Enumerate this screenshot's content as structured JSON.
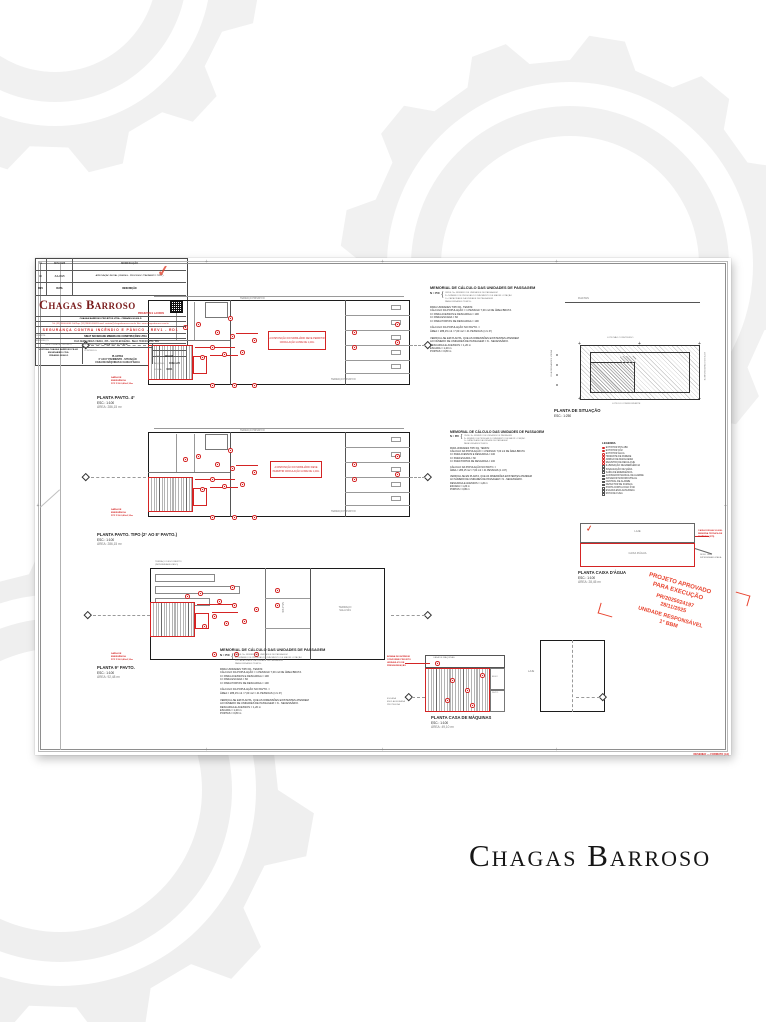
{
  "brand": {
    "wordmark": "Chagas Barroso"
  },
  "frame": {
    "note": "DESENHO — FORMATO (A1)"
  },
  "memorial": {
    "title": "MEMORIAL DE CÁLCULO DAS UNIDADES DE PASSAGEM",
    "formula": "N = P/C",
    "where": "ONDE: N= NÚMERO DE UNIDADES DE PASSAGEM\nP= NÚMERO DE PESSOAS DO PAVIMENTO DE MAIOR LOTAÇÃO\nC= CAPACIDADE DA UNIDADE DE PASSAGEM\nPARA UNIDADES TEMOS:",
    "body": "PARA UNIDADES TIPO D1, TEMOS:\nCÁLCULO DA POPULAÇÃO = 1 PESSOA/ 7,00 m2 DE ÁREA BRUTA\nC= PARA ACESSOS E DESCARGA = 100\nC= PARA ESCADA = 60\nC= PARA PORTAS DE DESCARGA = 100\n\nCÁLCULO DA POPULAÇÃO NO PAVTO. =\nÁREA = 286,15 m2 / 7,00 m2 = 41 PESSOAS (1 U.P.)\n\nVERIFICA-SE EM PLANTA, QUE AS DIMENSÕES EXISTENTES ATENDEM\nAO NÚMERO DE UNIDADES DE PASSAGEM = N - NECESSÁRIO.\nDESCARGA E ACESSOS = 1,20 m\nESCADA = 1,20 m\nPORTAS = 0,80 m"
  },
  "plans": {
    "shared": {
      "scale": "ESC.: 1:100",
      "terrace": "TERRAÇO PRIVATIVO",
      "mobiliario": "A DISPOSIÇÃO DO MOBILIÁRIO\nDEVE PERMITIR CIRCULAÇÃO\nLIVRE DE 1,20m",
      "exit": "SAÍDA DE\nEMERGÊNCIA\nPCF P-90 0,80x2,10m"
    },
    "p4": {
      "title": "PLANTA PAVTO. 4°",
      "area": "ÁREA: 286,15 m²"
    },
    "tipo": {
      "title": "PLANTA PAVTO. TIPO (2° AO 8° PAVTO.)",
      "area": "ÁREA: 286,15 m²"
    },
    "p9": {
      "title": "PLANTA 9° PAVTO.",
      "area": "ÁREA: 92,48 m²",
      "terrace_note": "TERRAÇO DESCOBERTO\n(IMPERMEABILIZADO)",
      "room_mid": "SALA 901",
      "room_right": "TERRAÇO\nSALA 901"
    },
    "caixa": {
      "title": "PLANTA CAIXA D'ÁGUA",
      "scale": "ESC.: 1:100",
      "area": "ÁREA: 28,45 m²",
      "laje": "LAJE",
      "tank": "CAIXA D'ÁGUA",
      "ann_red": "CAIXA D'ÁGUA 10.000L\nRESERVA TÉCNICA DE\nINCÊNDIO (RTI)",
      "ann_gray": "NÍVEL LAJE\nIMPERMEABILIZADA"
    },
    "maq": {
      "title": "PLANTA CASA DE MÁQUINAS",
      "scale": "ESC.: 1:100",
      "area": "ÁREA: 49,10 m²",
      "room": "CASA DE MÁQUINAS",
      "laje": "LAJE",
      "elev": "ELEV.",
      "duto": "DUTO",
      "ann_red": "BOMBA DE INCÊNDIO\nCONFORME PROJETO\nHIDRÁULICO DE\nPRESSURIZAÇÃO",
      "ann_gray": "ESCADA\nENCLAUSURADA\nPROTEGIDA"
    },
    "situacao": {
      "title": "PLANTA DE SITUAÇÃO",
      "scale": "ESC.: 1:250",
      "street_top": "RUA PAIS",
      "street_left": "RUA FERNANDES VIEIRA",
      "lot_top": "LOTE NÃO CONSTRUÍDO",
      "lot_bottom": "LOTE DO CONFRONTANTE",
      "lot_right": "LOTE DO CONFRONTANTE"
    }
  },
  "legend": {
    "title": "LEGENDA",
    "items": [
      "EXTINTOR PQS ABC",
      "EXTINTOR CO2",
      "EXTINTOR ÁGUA",
      "HIDRANTE DE PAREDE",
      "ABRIGO DE MANGUEIRA",
      "REGISTRO DE RECALQUE",
      "ILUMINAÇÃO DE EMERGÊNCIA",
      "SINALIZAÇÃO DE SAÍDA",
      "SAÍDA DE EMERGÊNCIA",
      "ACIONADOR MANUAL DE ALARME",
      "AVISADOR SONORO/VISUAL",
      "CENTRAL DE ALARME",
      "DETECTOR DE FUMAÇA",
      "PORTA CORTA-FOGO P-90",
      "ESCADA ENCLAUSURADA",
      "ROTA DE FUGA"
    ]
  },
  "stamp": {
    "head": "PROJETO APROVADO\nPARA EXECUÇÃO",
    "number": "PR/2025024197\n28/11/2025",
    "unit": "UNIDADE RESPONSÁVEL\n1° BBM"
  },
  "titleblock": {
    "revisions": [
      {
        "no": "01",
        "date": "NOV/2025",
        "desc": "MODIFICAÇÃO"
      },
      {
        "no": "00",
        "date": "JUL/2025",
        "desc": "APROVAÇÃO INICIAL (CBM-MG - PROCESSO \"PAVIMENTO TIPO\")"
      },
      {
        "no": "REV",
        "date": "DATA",
        "desc": "DESCRIÇÃO"
      }
    ],
    "logo": "Chagas Barroso",
    "logo_tag": "PROJETOS E LAUDOS",
    "company": "CHAGAS BARROSO PROJETOS LTDA - CREA/MG 00.000-D",
    "contacts": "Tel: (31) 3000-0000   Cel/Zap: (31) 99000-0000   E-mail: contato@chagasbarroso.com.br   Site: www.chagasbarroso.com.br",
    "project": "SEGURANÇA CONTRA INCÊNDIO E PÂNICO - REV1 - RD1",
    "client_label": "CLIENTE:",
    "client": "SINAT SOCIEDADE MINEIRA DE CONSTRUÇÕES LTDA",
    "address_label": "ENDEREÇO:",
    "address": "RUA FERNANDES VIEIRA, 456 - SANTA EFIGÊNIA - BELO HORIZONTE / MG",
    "rt_label": "RESPONSÁVEL TÉCNICO",
    "rt": "LUIZ DAS CHAGAS BARROSO FILHO\nENGENHEIRO CIVIL\nCREA/MG 00000-D",
    "class_label": "CLASSIFICAÇÃO:",
    "class_value": "ÁREA: (2+4, 5+1 e A+B)",
    "content_label": "CONTEÚDO:",
    "content": "PLANTAS\n4° AO 8° PAVIMENTO - SITUAÇÃO\nCASA DE MÁQUINAS E CAIXA D'ÁGUA",
    "date_label": "DATA:",
    "date": "NOV/25",
    "file_label": "ARQUIVO:",
    "file": "1009-1/25",
    "sheet_label": "FOLHA:",
    "sheet": "01/01"
  },
  "colors": {
    "red": "#d42424",
    "stamp_red": "#e8432e",
    "maroon": "#7a1c1c"
  }
}
